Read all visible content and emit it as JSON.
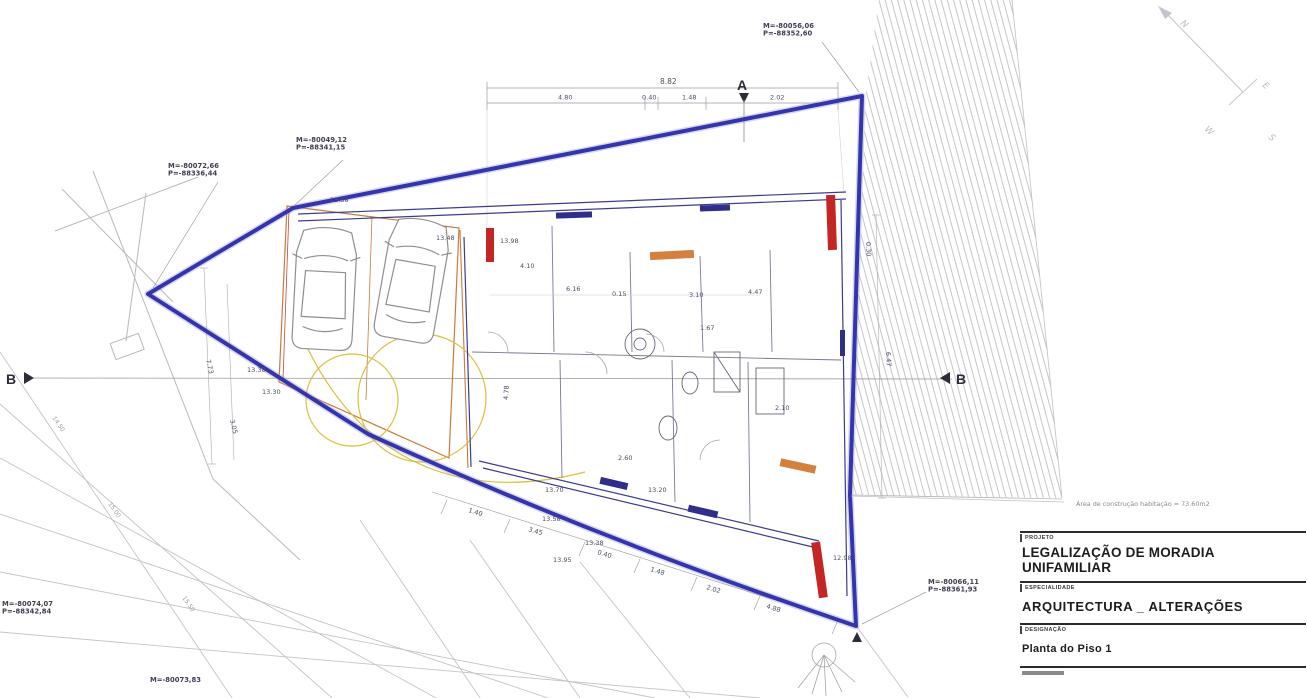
{
  "title_block": {
    "field1_label": "PROJETO",
    "project_title": "LEGALIZAÇÃO DE MORADIA UNIFAMILIAR",
    "field2_label": "ESPECIALIDADE",
    "specialty": "ARQUITECTURA _ ALTERAÇÕES",
    "field3_label": "DESIGNAÇÃO",
    "drawing_name": "Planta do Piso 1"
  },
  "area_note": "Área de construção habitação = 73.60m2",
  "compass": {
    "n": "N",
    "e": "E",
    "w": "W",
    "s": "S"
  },
  "sections": {
    "a": "A",
    "b_left": "B",
    "b_right": "B"
  },
  "top_dimensions": {
    "overall": "8.82",
    "segments": [
      "4.80",
      "0.40",
      "1.48",
      "2.02"
    ]
  },
  "coordinates": [
    {
      "id": "west-tip",
      "x": 168,
      "y": 168,
      "lines": [
        "M=-80072,66",
        "P=-88336,44"
      ]
    },
    {
      "id": "north-bend",
      "x": 296,
      "y": 142,
      "lines": [
        "M=-80049,12",
        "P=-88341,15"
      ]
    },
    {
      "id": "north-east",
      "x": 763,
      "y": 28,
      "lines": [
        "M=-80056,06",
        "P=-88352,60"
      ]
    },
    {
      "id": "south-west",
      "x": 2,
      "y": 606,
      "lines": [
        "M=-80074,07",
        "P=-88342,84"
      ]
    },
    {
      "id": "south",
      "x": 150,
      "y": 682,
      "lines": [
        "M=-80073,83"
      ]
    },
    {
      "id": "south-east",
      "x": 928,
      "y": 584,
      "lines": [
        "M=-80066,11",
        "P=-88361,93"
      ]
    }
  ],
  "annotations": [
    {
      "x": 520,
      "y": 268,
      "t": "4.10"
    },
    {
      "x": 566,
      "y": 291,
      "t": "6.16"
    },
    {
      "x": 612,
      "y": 296,
      "t": "0.15"
    },
    {
      "x": 689,
      "y": 297,
      "t": "3.10"
    },
    {
      "x": 748,
      "y": 294,
      "t": "4.47"
    },
    {
      "x": 508,
      "y": 400,
      "t": "4.78",
      "r": -87
    },
    {
      "x": 886,
      "y": 352,
      "t": "6.47",
      "r": 87
    },
    {
      "x": 866,
      "y": 242,
      "t": "0.30",
      "r": 87
    },
    {
      "x": 545,
      "y": 492,
      "t": "13.70"
    },
    {
      "x": 542,
      "y": 521,
      "t": "13.58"
    },
    {
      "x": 585,
      "y": 545,
      "t": "13.38"
    },
    {
      "x": 553,
      "y": 562,
      "t": "13.95"
    },
    {
      "x": 648,
      "y": 492,
      "t": "13.20"
    },
    {
      "x": 833,
      "y": 560,
      "t": "12.98"
    },
    {
      "x": 468,
      "y": 512,
      "t": "1.40",
      "r": 17
    },
    {
      "x": 528,
      "y": 531,
      "t": "3.45",
      "r": 17
    },
    {
      "x": 597,
      "y": 554,
      "t": "0.40",
      "r": 17
    },
    {
      "x": 650,
      "y": 571,
      "t": "1.48",
      "r": 17
    },
    {
      "x": 706,
      "y": 589,
      "t": "2.02",
      "r": 17
    },
    {
      "x": 766,
      "y": 608,
      "t": "4.88",
      "r": 17
    },
    {
      "x": 52,
      "y": 418,
      "t": "14.50",
      "r": 55,
      "cls": "ctr"
    },
    {
      "x": 108,
      "y": 504,
      "t": "15.00",
      "r": 55,
      "cls": "ctr"
    },
    {
      "x": 182,
      "y": 598,
      "t": "15.50",
      "r": 55,
      "cls": "ctr"
    },
    {
      "x": 206,
      "y": 360,
      "t": "7.73",
      "r": 77
    },
    {
      "x": 230,
      "y": 420,
      "t": "3.05",
      "r": 77
    },
    {
      "x": 330,
      "y": 202,
      "t": "13.38"
    },
    {
      "x": 436,
      "y": 240,
      "t": "13.48"
    },
    {
      "x": 247,
      "y": 372,
      "t": "13.38"
    },
    {
      "x": 262,
      "y": 394,
      "t": "13.30"
    },
    {
      "x": 500,
      "y": 243,
      "t": "13.98"
    },
    {
      "x": 618,
      "y": 460,
      "t": "2.60"
    },
    {
      "x": 700,
      "y": 330,
      "t": "1.67"
    },
    {
      "x": 775,
      "y": 410,
      "t": "2.10"
    }
  ],
  "colors": {
    "boundary_blue": "#3434ad",
    "demolition_red": "#c42525",
    "existing_orange": "#cc7a3a",
    "turning_yellow": "#ddbf3e",
    "hatch_gray": "#c6c6c6"
  }
}
